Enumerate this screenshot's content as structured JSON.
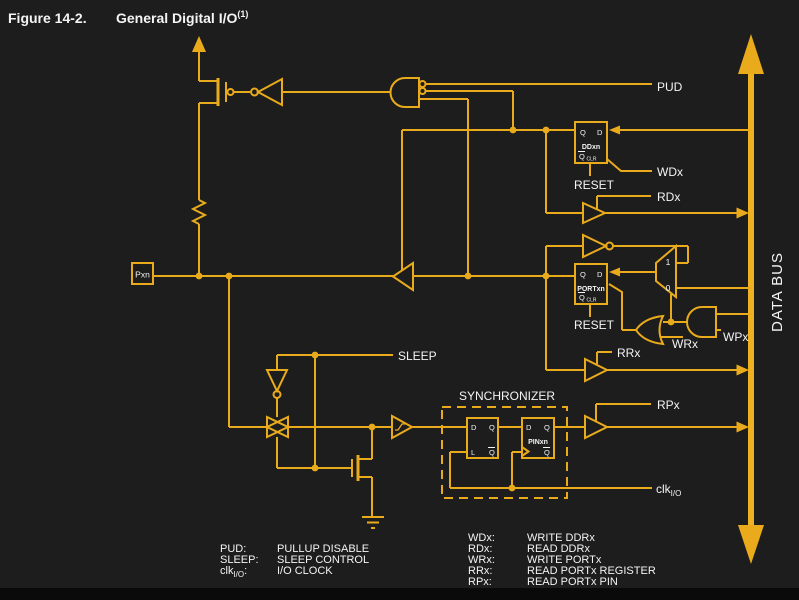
{
  "title": {
    "figure_label": "Figure 14-2.",
    "caption": "General Digital I/O",
    "footnote_ref": "(1)"
  },
  "colors": {
    "background": "#1d1d1d",
    "wire": "#e9ab1c",
    "label_text": "#f4f4f4",
    "bottom_bar": "#0a0a0a"
  },
  "data_bus": {
    "label": "DATA BUS"
  },
  "pin": {
    "label": "Pxn"
  },
  "signal_labels": {
    "pud": "PUD",
    "wdx": "WDx",
    "rdx": "RDx",
    "reset_ddr": "RESET",
    "reset_port": "RESET",
    "wrx": "WRx",
    "wpx": "WPx",
    "rrx": "RRx",
    "rpx": "RPx",
    "sleep": "SLEEP",
    "clk_base": "clk",
    "clk_sub": "I/O",
    "synchronizer": "SYNCHRONIZER"
  },
  "registers": {
    "ddxn": {
      "q": "Q",
      "d": "D",
      "name": "DDxn",
      "qbar": "Q",
      "clr": "CLR"
    },
    "portxn": {
      "q": "Q",
      "d": "D",
      "name": "PORTxn",
      "qbar": "Q",
      "clr": "CLR"
    },
    "sync_latch": {
      "d": "D",
      "q": "Q",
      "l": "L",
      "qbar": "Q"
    },
    "pinxn": {
      "d": "D",
      "q": "Q",
      "name": "PINxn",
      "qbar": "Q"
    }
  },
  "mux": {
    "input_one": "1",
    "input_zero": "0"
  },
  "legend_left": [
    {
      "term": "PUD:",
      "definition": "PULLUP DISABLE"
    },
    {
      "term": "SLEEP:",
      "definition": "SLEEP CONTROL"
    },
    {
      "term_base": "clk",
      "term_sub": "I/O",
      "term_colon": ":",
      "definition": "I/O CLOCK"
    }
  ],
  "legend_right": [
    {
      "term": "WDx:",
      "definition": "WRITE DDRx"
    },
    {
      "term": "RDx:",
      "definition": "READ DDRx"
    },
    {
      "term": "WRx:",
      "definition": "WRITE PORTx"
    },
    {
      "term": "RRx:",
      "definition": "READ PORTx REGISTER"
    },
    {
      "term": "RPx:",
      "definition": "READ PORTx PIN"
    },
    {
      "term": "WPx:",
      "definition": "WRITE PINx REGISTER"
    }
  ]
}
